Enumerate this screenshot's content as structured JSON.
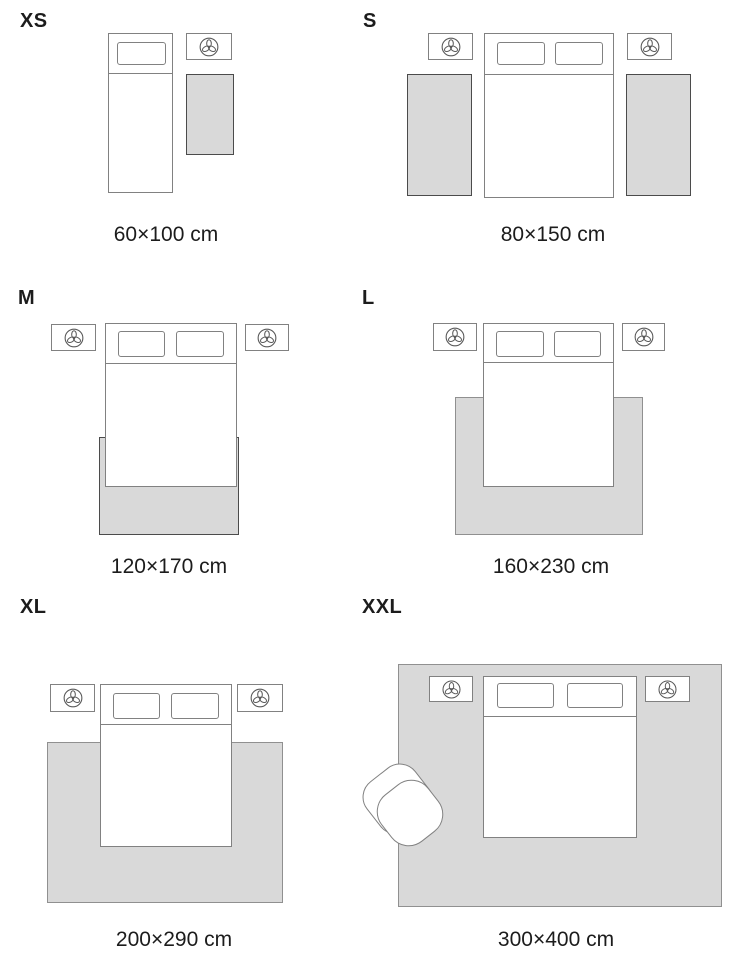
{
  "colors": {
    "bg": "#ffffff",
    "text": "#1c1c1c",
    "furn": "#818181",
    "rug_fill": "#d9d9d9",
    "rug_border_dark": "#4b4b4b",
    "rug_border_light": "#909090",
    "lamp_icon_stroke": "#5a5a5a"
  },
  "icons": {
    "nightstand_lamp": "trefoil-plant-top-view-icon"
  },
  "panels": [
    {
      "id": "xs",
      "label": "XS",
      "size": "60×100 cm",
      "bed": "single",
      "nightstands": 1,
      "rugs": 1,
      "rug_placement": "beside-bed"
    },
    {
      "id": "s",
      "label": "S",
      "size": "80×150 cm",
      "bed": "double",
      "nightstands": 2,
      "rugs": 2,
      "rug_placement": "runner-both-sides"
    },
    {
      "id": "m",
      "label": "M",
      "size": "120×170 cm",
      "bed": "double",
      "nightstands": 2,
      "rugs": 1,
      "rug_placement": "under-foot-of-bed"
    },
    {
      "id": "l",
      "label": "L",
      "size": "160×230 cm",
      "bed": "double",
      "nightstands": 2,
      "rugs": 1,
      "rug_placement": "under-lower-two-thirds"
    },
    {
      "id": "xl",
      "label": "XL",
      "size": "200×290 cm",
      "bed": "double",
      "nightstands": 2,
      "rugs": 1,
      "rug_placement": "under-bed-wide"
    },
    {
      "id": "xxl",
      "label": "XXL",
      "size": "300×400 cm",
      "bed": "double",
      "nightstands": 2,
      "rugs": 1,
      "rug_placement": "whole-room",
      "extra": "armchair"
    }
  ]
}
